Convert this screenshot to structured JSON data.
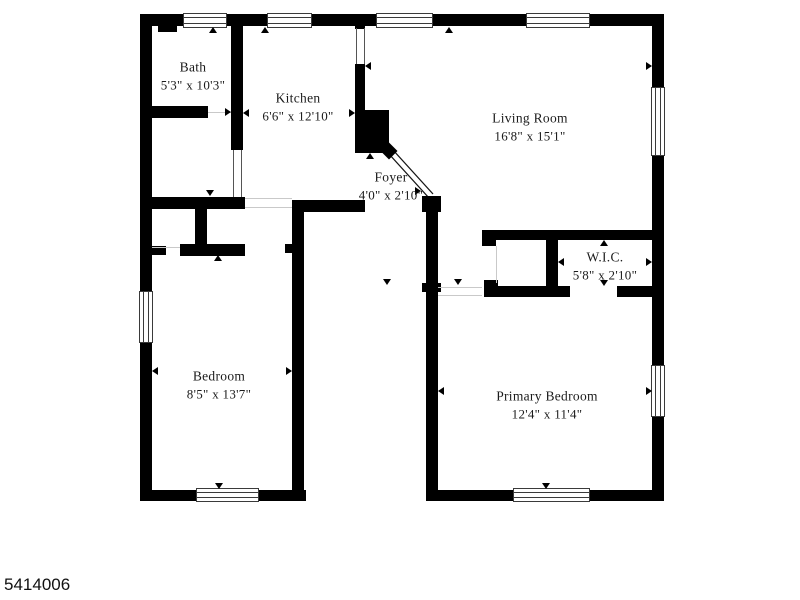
{
  "footer": {
    "listing_id": "5414006"
  },
  "colors": {
    "background": "#ffffff",
    "wall": "#000000",
    "label_text": "#1b1b1b",
    "window_frame": "#3a3a3a",
    "faint_line": "#c9c9c9"
  },
  "rooms": [
    {
      "slug": "bath",
      "name": "Bath",
      "dims": "5'3\" x 10'3\"",
      "cx": 193,
      "cy": 76
    },
    {
      "slug": "kitchen",
      "name": "Kitchen",
      "dims": "6'6\" x 12'10\"",
      "cx": 298,
      "cy": 107
    },
    {
      "slug": "living-room",
      "name": "Living Room",
      "dims": "16'8\" x 15'1\"",
      "cx": 530,
      "cy": 127
    },
    {
      "slug": "foyer",
      "name": "Foyer",
      "dims": "4'0\" x 2'10\"",
      "cx": 391,
      "cy": 186
    },
    {
      "slug": "wic",
      "name": "W.I.C.",
      "dims": "5'8\" x 2'10\"",
      "cx": 605,
      "cy": 266
    },
    {
      "slug": "bedroom",
      "name": "Bedroom",
      "dims": "8'5\" x 13'7\"",
      "cx": 219,
      "cy": 385
    },
    {
      "slug": "primary-bedroom",
      "name": "Primary Bedroom",
      "dims": "12'4\" x 11'4\"",
      "cx": 547,
      "cy": 405
    }
  ],
  "floorplan": {
    "walls": [
      {
        "x": 140,
        "y": 14,
        "w": 524,
        "h": 12
      },
      {
        "x": 140,
        "y": 14,
        "w": 12,
        "h": 487
      },
      {
        "x": 652,
        "y": 14,
        "w": 12,
        "h": 487
      },
      {
        "x": 140,
        "y": 490,
        "w": 166,
        "h": 11
      },
      {
        "x": 426,
        "y": 490,
        "w": 238,
        "h": 11
      },
      {
        "x": 231,
        "y": 26,
        "w": 12,
        "h": 124
      },
      {
        "x": 140,
        "y": 106,
        "w": 68,
        "h": 12
      },
      {
        "x": 158,
        "y": 26,
        "w": 19,
        "h": 6
      },
      {
        "x": 140,
        "y": 197,
        "w": 105,
        "h": 12
      },
      {
        "x": 195,
        "y": 209,
        "w": 12,
        "h": 47
      },
      {
        "x": 180,
        "y": 244,
        "w": 65,
        "h": 12
      },
      {
        "x": 152,
        "y": 246,
        "w": 14,
        "h": 9
      },
      {
        "x": 292,
        "y": 200,
        "w": 12,
        "h": 301
      },
      {
        "x": 292,
        "y": 200,
        "w": 73,
        "h": 12
      },
      {
        "x": 285,
        "y": 244,
        "w": 7,
        "h": 9
      },
      {
        "x": 355,
        "y": 26,
        "w": 10,
        "h": 3
      },
      {
        "x": 355,
        "y": 64,
        "w": 10,
        "h": 48
      },
      {
        "x": 355,
        "y": 110,
        "w": 34,
        "h": 43
      },
      {
        "x": 426,
        "y": 196,
        "w": 12,
        "h": 305
      },
      {
        "x": 422,
        "y": 196,
        "w": 19,
        "h": 16
      },
      {
        "x": 422,
        "y": 283,
        "w": 19,
        "h": 9
      },
      {
        "x": 482,
        "y": 230,
        "w": 170,
        "h": 10
      },
      {
        "x": 482,
        "y": 230,
        "w": 14,
        "h": 16
      },
      {
        "x": 546,
        "y": 240,
        "w": 12,
        "h": 47
      },
      {
        "x": 484,
        "y": 286,
        "w": 86,
        "h": 11
      },
      {
        "x": 617,
        "y": 286,
        "w": 35,
        "h": 11
      },
      {
        "x": 484,
        "y": 280,
        "w": 14,
        "h": 17
      }
    ],
    "windows": [
      {
        "x": 183,
        "y": 13,
        "w": 44,
        "h": 15,
        "o": "h"
      },
      {
        "x": 267,
        "y": 13,
        "w": 45,
        "h": 15,
        "o": "h"
      },
      {
        "x": 376,
        "y": 13,
        "w": 57,
        "h": 15,
        "o": "h"
      },
      {
        "x": 526,
        "y": 13,
        "w": 64,
        "h": 15,
        "o": "h"
      },
      {
        "x": 139,
        "y": 291,
        "w": 14,
        "h": 52,
        "o": "v"
      },
      {
        "x": 651,
        "y": 87,
        "w": 14,
        "h": 69,
        "o": "v"
      },
      {
        "x": 651,
        "y": 365,
        "w": 14,
        "h": 52,
        "o": "v"
      },
      {
        "x": 196,
        "y": 488,
        "w": 63,
        "h": 14,
        "o": "h"
      },
      {
        "x": 513,
        "y": 488,
        "w": 77,
        "h": 14,
        "o": "h"
      }
    ],
    "opening_lines": [
      {
        "x": 356,
        "y": 28,
        "w": 1,
        "h": 36
      },
      {
        "x": 364,
        "y": 28,
        "w": 1,
        "h": 36
      },
      {
        "x": 233,
        "y": 150,
        "w": 1,
        "h": 47
      },
      {
        "x": 241,
        "y": 150,
        "w": 1,
        "h": 47
      }
    ],
    "faint_lines": [
      {
        "x": 208,
        "y": 112,
        "w": 23,
        "h": 1
      },
      {
        "x": 245,
        "y": 198,
        "w": 47,
        "h": 1
      },
      {
        "x": 245,
        "y": 207,
        "w": 47,
        "h": 1
      },
      {
        "x": 152,
        "y": 247,
        "w": 28,
        "h": 1
      },
      {
        "x": 438,
        "y": 287,
        "w": 44,
        "h": 1
      },
      {
        "x": 438,
        "y": 295,
        "w": 44,
        "h": 1
      },
      {
        "x": 496,
        "y": 246,
        "w": 1,
        "h": 37
      }
    ],
    "measure_arrows": [
      {
        "x": 213,
        "y": 27,
        "d": "up"
      },
      {
        "x": 265,
        "y": 27,
        "d": "up"
      },
      {
        "x": 449,
        "y": 27,
        "d": "up"
      },
      {
        "x": 210,
        "y": 196,
        "d": "down"
      },
      {
        "x": 218,
        "y": 255,
        "d": "up"
      },
      {
        "x": 231,
        "y": 112,
        "d": "right"
      },
      {
        "x": 243,
        "y": 113,
        "d": "left"
      },
      {
        "x": 355,
        "y": 113,
        "d": "right"
      },
      {
        "x": 365,
        "y": 66,
        "d": "left"
      },
      {
        "x": 652,
        "y": 66,
        "d": "right"
      },
      {
        "x": 370,
        "y": 153,
        "d": "up"
      },
      {
        "x": 421,
        "y": 191,
        "d": "right"
      },
      {
        "x": 152,
        "y": 371,
        "d": "left"
      },
      {
        "x": 292,
        "y": 371,
        "d": "right"
      },
      {
        "x": 219,
        "y": 489,
        "d": "down"
      },
      {
        "x": 438,
        "y": 391,
        "d": "left"
      },
      {
        "x": 652,
        "y": 391,
        "d": "right"
      },
      {
        "x": 546,
        "y": 489,
        "d": "down"
      },
      {
        "x": 558,
        "y": 262,
        "d": "left"
      },
      {
        "x": 652,
        "y": 262,
        "d": "right"
      },
      {
        "x": 604,
        "y": 240,
        "d": "up"
      },
      {
        "x": 604,
        "y": 286,
        "d": "down"
      },
      {
        "x": 458,
        "y": 285,
        "d": "down"
      },
      {
        "x": 387,
        "y": 285,
        "d": "down"
      }
    ],
    "diagonal_wall": {
      "line1": {
        "x1": 389,
        "y1": 154,
        "x2": 429,
        "y2": 198
      },
      "line2": {
        "x1": 393,
        "y1": 150,
        "x2": 433,
        "y2": 194
      },
      "diamond": {
        "cx": 389,
        "cy": 151
      }
    }
  }
}
